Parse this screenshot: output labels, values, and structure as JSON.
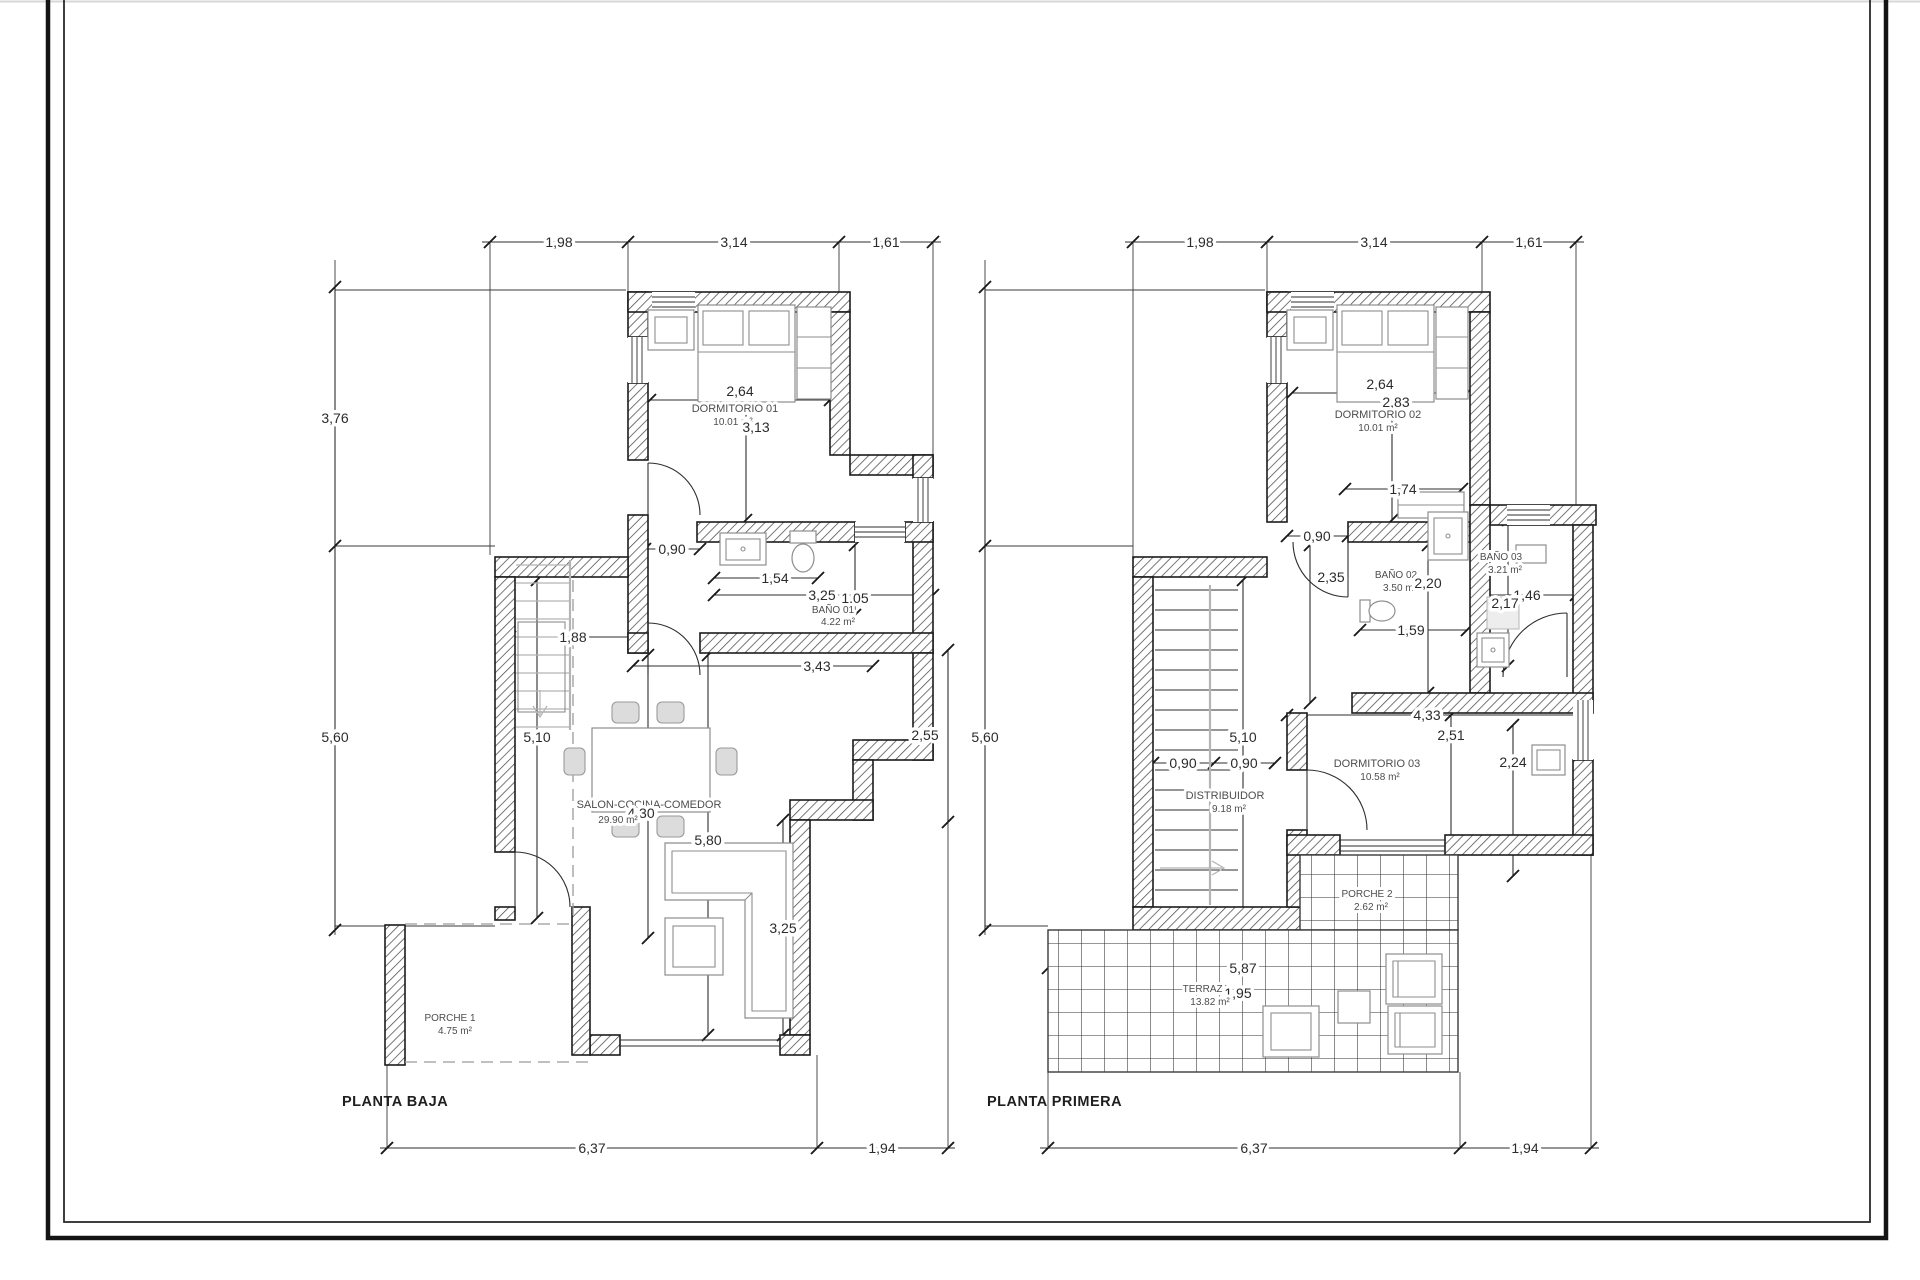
{
  "drawing_type": "floor-plan",
  "p0": {
    "title": "PLANTA BAJA",
    "rooms": {
      "dorm": {
        "name": "DORMITORIO 01",
        "area": "10.01 m²"
      },
      "bano": {
        "name": "BAÑO 01",
        "area": "4.22 m²"
      },
      "salon": {
        "name": "SALON-COCINA-COMEDOR",
        "area": "29.90 m²"
      },
      "porche": {
        "name": "PORCHE 1",
        "area": "4.75 m²"
      }
    },
    "dims": {
      "top1": "1,98",
      "top2": "3,14",
      "top3": "1,61",
      "left1": "3,76",
      "left2": "5,60",
      "bot1": "6,37",
      "bot2": "1,94",
      "w264": "2,64",
      "h313": "3,13",
      "d090": "0,90",
      "d154": "1,54",
      "d325": "3,25",
      "d105": "1,05",
      "d188": "1,88",
      "d343": "3,43",
      "d510": "5,10",
      "d255": "2,55",
      "d430": "4,30",
      "d580": "5,80",
      "d325b": "3,25"
    }
  },
  "p1": {
    "title": "PLANTA PRIMERA",
    "rooms": {
      "dorm2": {
        "name": "DORMITORIO 02",
        "area": "10.01 m²"
      },
      "bano2": {
        "name": "BAÑO 02",
        "area": "3.50 m²"
      },
      "bano3": {
        "name": "BAÑO 03",
        "area": "3.21 m²"
      },
      "dorm3": {
        "name": "DORMITORIO 03",
        "area": "10.58 m²"
      },
      "distr": {
        "name": "DISTRIBUIDOR",
        "area": "9.18 m²"
      },
      "porche2": {
        "name": "PORCHE 2",
        "area": "2.62 m²"
      },
      "terraza": {
        "name": "TERRAZA",
        "area": "13.82 m²"
      }
    },
    "dims": {
      "top1": "1,98",
      "top2": "3,14",
      "top3": "1,61",
      "left2": "5,60",
      "bot1": "6,37",
      "bot2": "1,94",
      "w264": "2,64",
      "h283": "2,83",
      "d174": "1,74",
      "d090": "0,90",
      "d235": "2,35",
      "d220": "2,20",
      "d159": "1,59",
      "d146": "1,46",
      "d217": "2,17",
      "d433": "4,33",
      "d251": "2,51",
      "d224": "2,24",
      "d510": "5,10",
      "d090a": "0,90",
      "d090b": "0,90",
      "d587": "5,87",
      "d195": "1,95"
    }
  }
}
